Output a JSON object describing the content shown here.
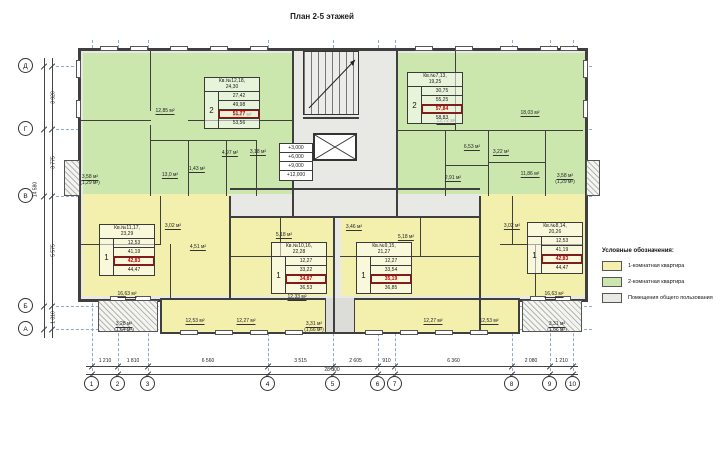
{
  "title": "План 2-5 этажей",
  "legend": {
    "heading": "Условные обозначения:",
    "items": [
      {
        "label": "1-комнатная квартира",
        "color": "#f3efad"
      },
      {
        "label": "2-комнатная квартира",
        "color": "#cbe7ae"
      },
      {
        "label": "Помещения общего пользования",
        "color": "#e8e8e4"
      }
    ]
  },
  "axes": {
    "horizontal": [
      "1",
      "2",
      "3",
      "4",
      "5",
      "6",
      "7",
      "8",
      "9",
      "10"
    ],
    "vertical": [
      "Д",
      "Г",
      "В",
      "Б",
      "А"
    ]
  },
  "dimensions": {
    "bottom_segments": [
      "1 210",
      "1 810",
      "6 560",
      "3 515",
      "2 605",
      "910",
      "6 360",
      "2 080",
      "1 210"
    ],
    "bottom_total": "28 800",
    "left_segments": [
      "3 920",
      "3 775",
      "5 575",
      "1 310"
    ],
    "left_total": "14 580"
  },
  "elevations": [
    "+3,000",
    "+6,000",
    "+9,000",
    "+12,000"
  ],
  "apartment_tables": [
    {
      "unit": "Кв.№12,18,",
      "unit2": "24,30",
      "rooms": "2",
      "areas": [
        "27,42",
        "49,98",
        "51,77",
        "53,56"
      ],
      "highlight_index": 2
    },
    {
      "unit": "Кв.№7,13,",
      "unit2": "19,25",
      "rooms": "2",
      "areas": [
        "30,75",
        "55,25",
        "57,84",
        "58,83"
      ],
      "highlight_index": 2
    },
    {
      "unit": "Кв.№11,17,",
      "unit2": "23,29",
      "rooms": "1",
      "areas": [
        "12,53",
        "41,19",
        "42,83",
        "44,47"
      ],
      "highlight_index": 2
    },
    {
      "unit": "Кв.№10,16,",
      "unit2": "22,28",
      "rooms": "1",
      "areas": [
        "12,27",
        "33,22",
        "34,87",
        "36,53"
      ],
      "highlight_index": 2
    },
    {
      "unit": "Кв.№9,15,",
      "unit2": "21,27",
      "rooms": "1",
      "areas": [
        "12,27",
        "33,54",
        "35,19",
        "36,85"
      ],
      "highlight_index": 2
    },
    {
      "unit": "Кв.№8,14,",
      "unit2": "20,26",
      "rooms": "1",
      "areas": [
        "12,53",
        "41,19",
        "42,83",
        "44,47"
      ],
      "highlight_index": 2
    }
  ],
  "room_labels": [
    "12,85 м²",
    "13,57 м²",
    "13,0 м²",
    "1,43 м²",
    "4,97 м²",
    "3,18 м²",
    "3,58 м²",
    "(1,29 м²)",
    "12,72 м²",
    "18,03 м²",
    "6,53 м²",
    "2,91 м²",
    "3,22 м²",
    "11,86 м²",
    "3,58 м²",
    "(1,29 м²)",
    "16,63 м²",
    "12,53 м²",
    "12,27 м²",
    "12,33 м²",
    "3,02 м²",
    "4,51 м²",
    "5,18 м²",
    "3,46 м²",
    "5,18 м²",
    "3,02 м²",
    "12,27 м²",
    "12,53 м²",
    "16,63 м²",
    "3,28 м²",
    "(1,64 м²)",
    "3,31 м²",
    "(1,66 м²)",
    "3,31 м²",
    "(1,66 м²)"
  ],
  "colors": {
    "one_room": "#f3efad",
    "two_room": "#cbe7ae",
    "common": "#e8e8e4",
    "wall": "#3f3f3f",
    "highlight": "#c40000",
    "grid_dash": "#7d9cc0"
  }
}
